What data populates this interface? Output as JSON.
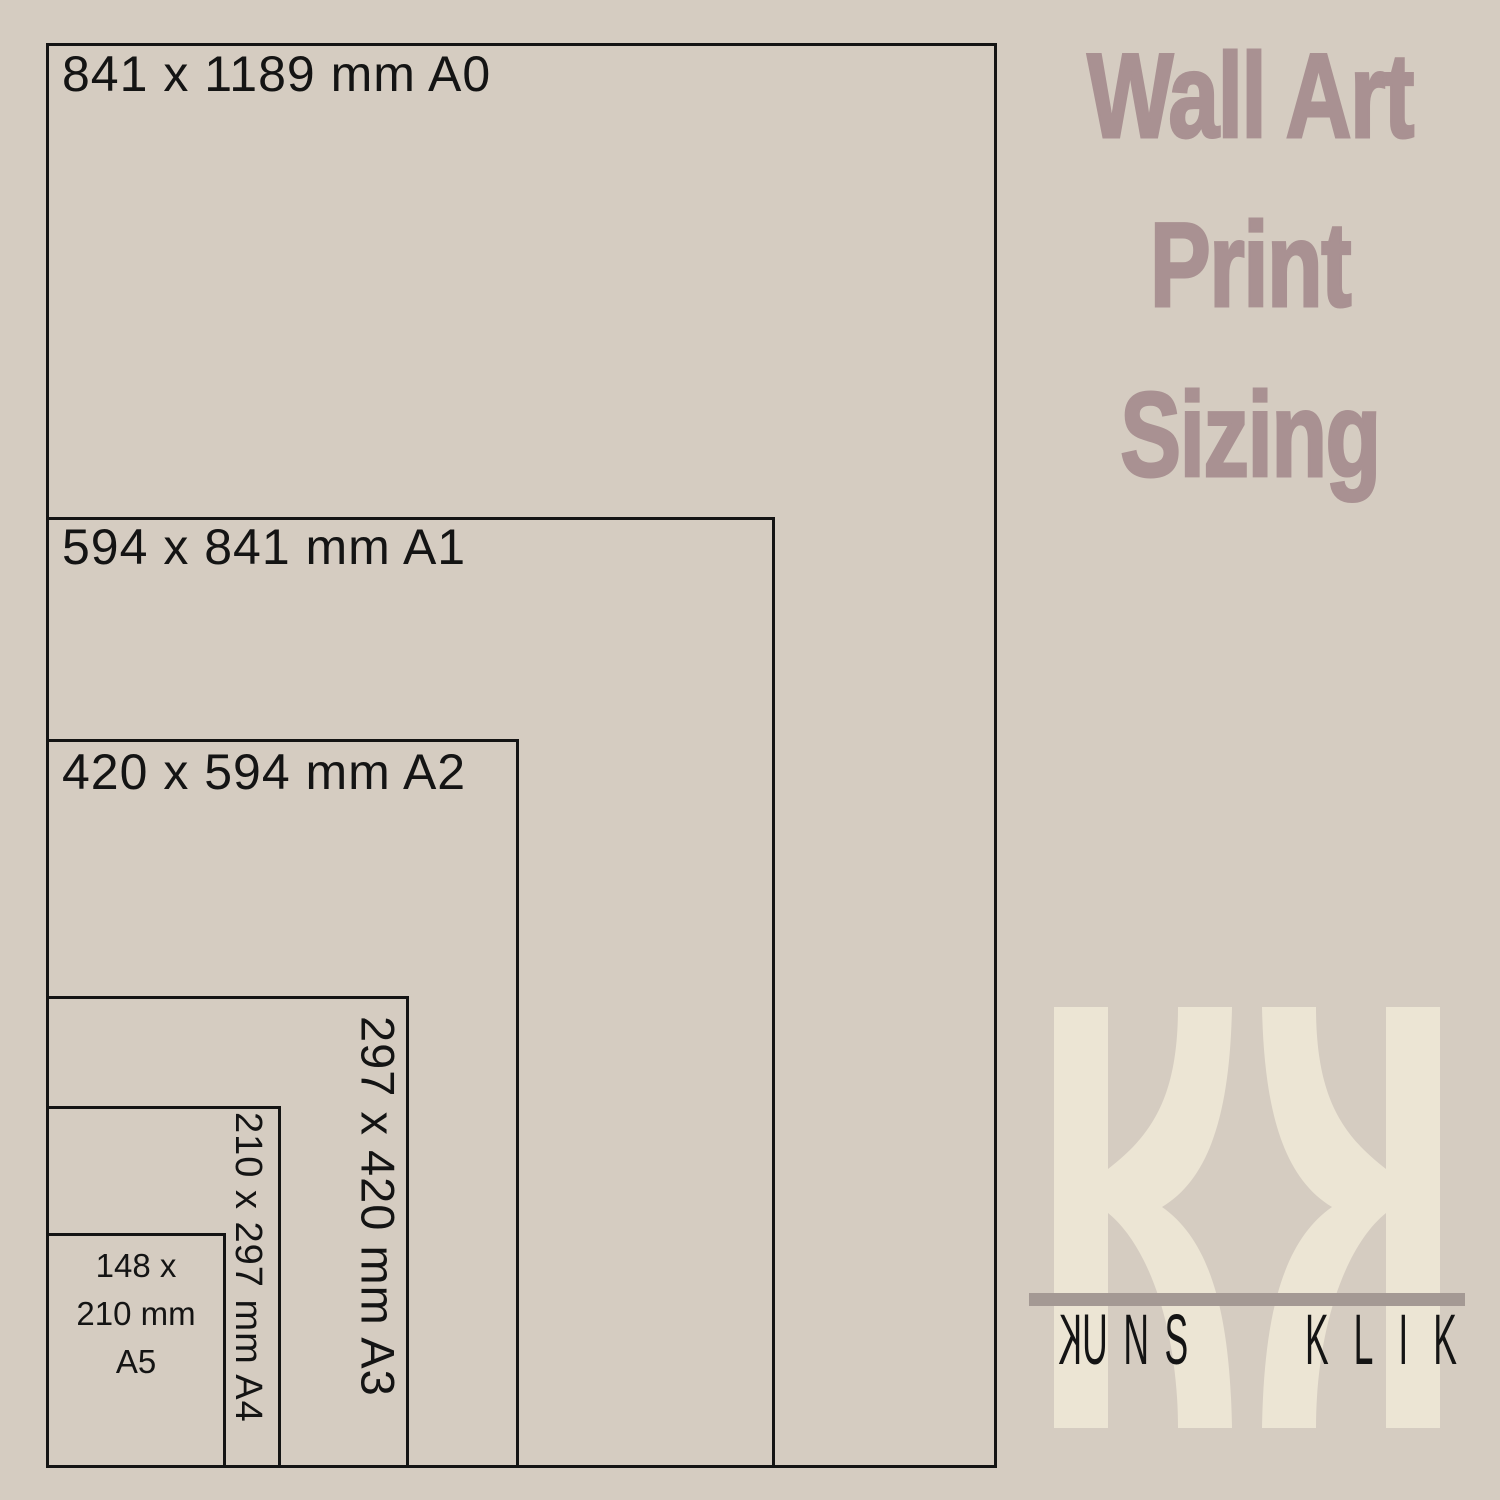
{
  "title": {
    "lines": [
      "Wall Art",
      "Print",
      "Sizing"
    ],
    "color": "#a99192"
  },
  "sizes": [
    {
      "name": "A0",
      "dimensions_mm": "841 x 1189",
      "label": "841 x 1189 mm A0",
      "label_orientation": "horizontal"
    },
    {
      "name": "A1",
      "dimensions_mm": "594 x 841",
      "label": "594 x 841 mm A1",
      "label_orientation": "horizontal"
    },
    {
      "name": "A2",
      "dimensions_mm": "420 x 594",
      "label": "420 x 594 mm A2",
      "label_orientation": "horizontal"
    },
    {
      "name": "A3",
      "dimensions_mm": "297 x 420",
      "label": "297 x 420 mm A3",
      "label_orientation": "vertical"
    },
    {
      "name": "A4",
      "dimensions_mm": "210 x 297",
      "label": "210 x 297 mm A4",
      "label_orientation": "vertical"
    },
    {
      "name": "A5",
      "dimensions_mm": "148 x 210",
      "label_lines": [
        "148 x",
        "210 mm",
        "A5"
      ],
      "label_orientation": "horizontal"
    }
  ],
  "logo": {
    "monogram_letters": "KK",
    "monogram_left_mirrored": false,
    "monogram_right_mirrored": true,
    "wordmark_first_initial": "K",
    "wordmark_first_rest": "UNS",
    "wordmark_second": "KLIK",
    "monogram_color": "#ece5d4",
    "bar_color": "#a49994",
    "wordmark_color": "#141414"
  },
  "colors": {
    "background": "#d5ccc1",
    "outline": "#141414",
    "label_text": "#141414",
    "title_text": "#a99192"
  }
}
